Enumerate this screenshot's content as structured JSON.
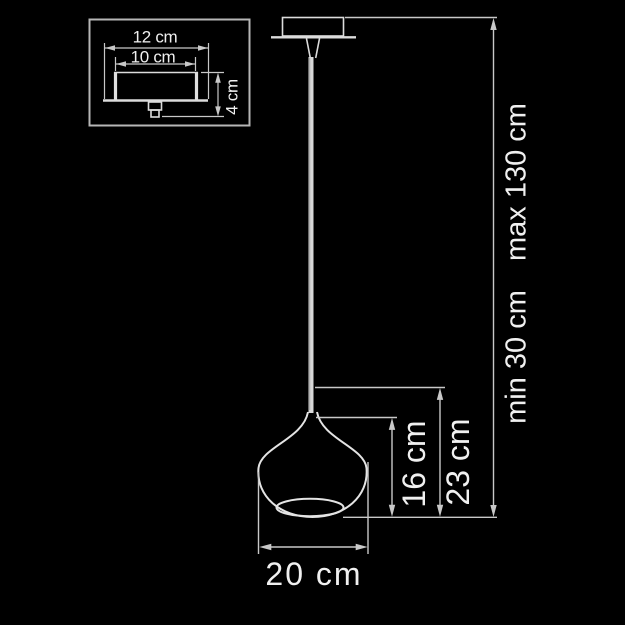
{
  "diagram": {
    "background_color": "#000000",
    "line_color": "#c8c8c8",
    "outline_color": "#e4e4e4",
    "text_color": "#f0f0f0"
  },
  "inset": {
    "plate_width_label": "12 cm",
    "body_width_label": "10 cm",
    "canopy_height_label": "4 cm"
  },
  "main": {
    "shade_diameter_label": "20 cm",
    "shade_height_label": "16 cm",
    "shade_overall_height_label": "23 cm",
    "suspension_min_label": "min 30 cm",
    "suspension_max_label": "max 130 cm"
  }
}
